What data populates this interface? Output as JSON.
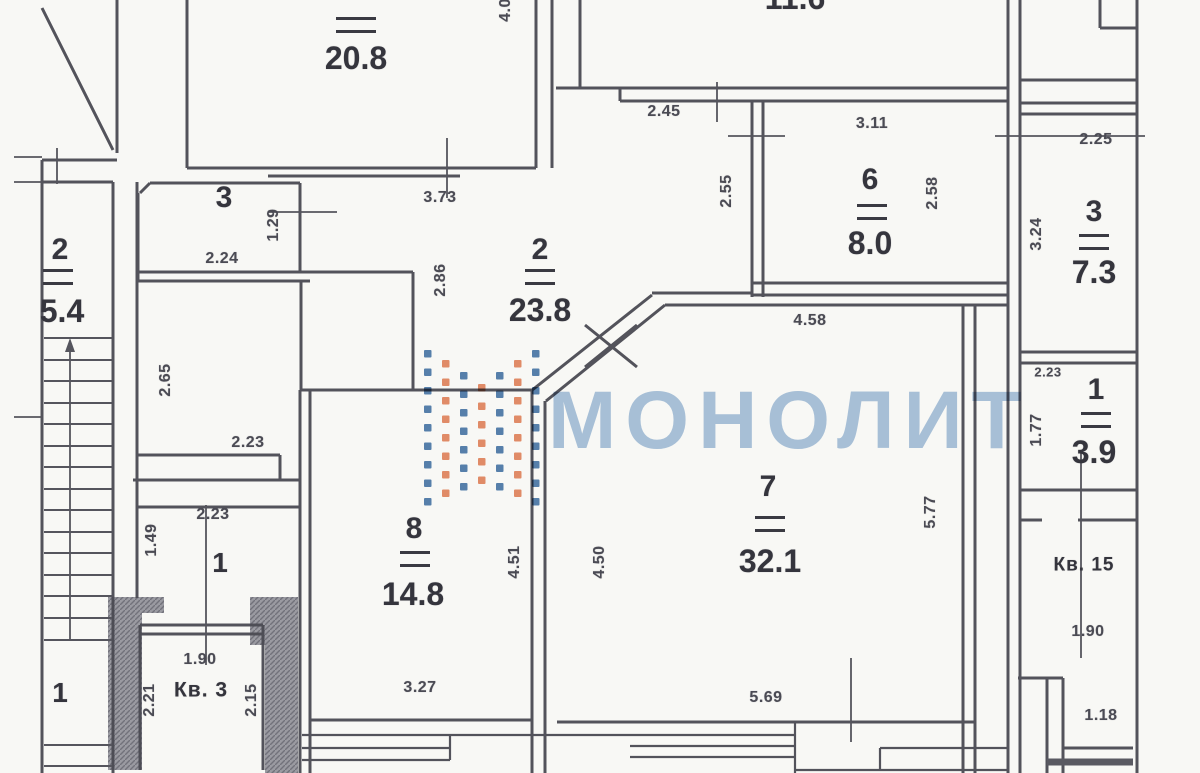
{
  "watermark": {
    "text": "МОНОЛИТ",
    "text_color": "#a5c0dd",
    "dot_blue": "#4a78ab",
    "dot_orange": "#e5855e"
  },
  "rooms": [
    {
      "number": "4",
      "area": "20.8"
    },
    {
      "number": "2",
      "area": "23.8"
    },
    {
      "number": "3",
      "area": ""
    },
    {
      "number": "2",
      "area": "5.4"
    },
    {
      "number": "6",
      "area": "8.0"
    },
    {
      "number": "3",
      "area": "7.3"
    },
    {
      "number": "1",
      "area": "3.9"
    },
    {
      "number": "7",
      "area": "32.1"
    },
    {
      "number": "8",
      "area": "14.8"
    }
  ],
  "corridor_labels": {
    "a": "1",
    "b": "1"
  },
  "apartment_labels": {
    "kv3": "Кв. 3",
    "kv15": "Кв. 15"
  },
  "partial_labels": {
    "top_area": "11.6",
    "top_dim_vertical": "4.0"
  },
  "dims": {
    "d0": "2.45",
    "d1": "3.11",
    "d2": "2.25",
    "d3": "2.55",
    "d4": "2.58",
    "d5": "3.24",
    "d6": "1.29",
    "d7": "2.24",
    "d8": "3.73",
    "d9": "2.86",
    "d10": "4.58",
    "d11": "2.65",
    "d12": "2.23",
    "d13": "2.23",
    "d14": "1.49",
    "d15": "2.23",
    "d16": "1.77",
    "d17": "5.77",
    "d18": "4.51",
    "d19": "4.50",
    "d20": "3.27",
    "d21": "5.69",
    "d22": "1.90",
    "d23": "2.21",
    "d24": "2.15",
    "d25": "1.90",
    "d26": "1.18",
    "d27": "4.0",
    "d28": "11.6"
  }
}
